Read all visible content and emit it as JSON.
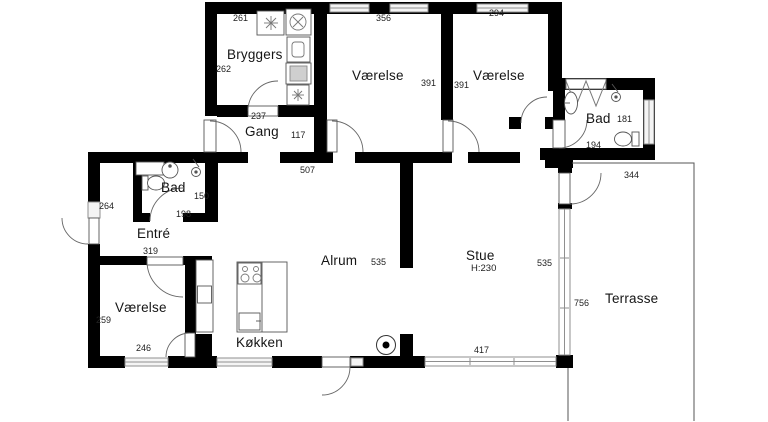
{
  "plan": {
    "title": "Floor plan",
    "background_color": "#ffffff",
    "wall_color": "#000000",
    "rooms": {
      "bryggers": {
        "name": "Bryggers",
        "dim_top": "261",
        "dim_left": "262",
        "dim_bottom": "237"
      },
      "vaerelse_nw": {
        "name": "Værelse",
        "dim_top": "356",
        "dim_right": "391"
      },
      "vaerelse_ne": {
        "name": "Værelse",
        "dim_top": "294",
        "dim_left": "391"
      },
      "bad_ne": {
        "name": "Bad",
        "dim_right": "181",
        "dim_bottom": "194"
      },
      "gang": {
        "name": "Gang",
        "dim_width": "117",
        "dim_south": "507"
      },
      "bad_w": {
        "name": "Bad",
        "dim_right": "150",
        "dim_bottom": "198"
      },
      "entre": {
        "name": "Entré",
        "dim_left": "264",
        "dim_bottom": "319"
      },
      "vaerelse_sw": {
        "name": "Værelse",
        "dim_left": "259",
        "dim_bottom": "246"
      },
      "koekken": {
        "name": "Køkken"
      },
      "alrum": {
        "name": "Alrum",
        "dim_width": "535"
      },
      "stue": {
        "name": "Stue",
        "ceiling_height": "H:230",
        "dim_width": "535",
        "dim_window_south": "417"
      },
      "terrasse": {
        "name": "Terrasse",
        "dim_top": "344",
        "dim_left": "756"
      }
    }
  }
}
